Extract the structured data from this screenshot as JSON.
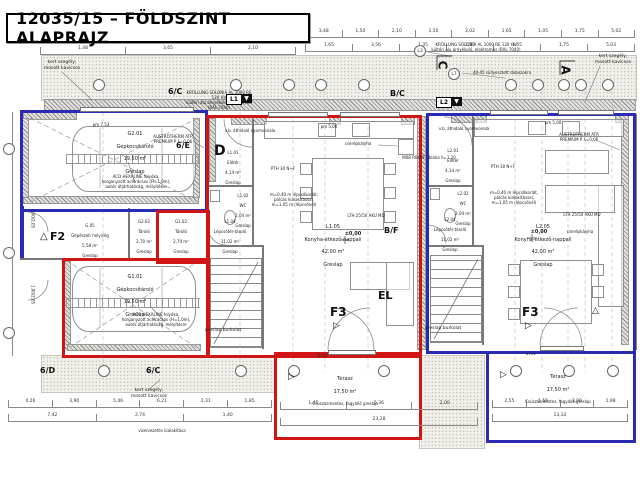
{
  "title": "12035/15 – FÖLDSZINT ALAPRAJZ",
  "colors": {
    "wall_blue": "#2a2ab5",
    "wall_red": "#d11414"
  },
  "rooms": {
    "g201": {
      "id": "G2.01",
      "name": "Gépkocsitároló",
      "area": "19,50 m²",
      "floor": "Greslap"
    },
    "g101": {
      "id": "G1.01",
      "name": "Gépkocsitároló",
      "area": "19,50 m²",
      "floor": "Greslap"
    },
    "g05": {
      "id": "G.05",
      "name": "Gépészeti helyiség",
      "area": "5,58 m²",
      "floor": "Greslap"
    },
    "g202": {
      "id": "G2.02",
      "name": "Tároló",
      "area": "2,70 m²",
      "floor": "Greslap"
    },
    "g102": {
      "id": "G1.02",
      "name": "Tároló",
      "area": "2,70 m²",
      "floor": "Greslap"
    },
    "l101": {
      "id": "L1.01",
      "name": "Előtér",
      "area": "4,14 m²",
      "floor": "Greslap"
    },
    "l102": {
      "id": "L1.02",
      "name": "WC",
      "area": "2,04 m²",
      "floor": "Greslap"
    },
    "l104": {
      "id": "L1.04",
      "name": "Lépcsőtér-tároló",
      "area": "11,02 m²",
      "floor": "Greslap"
    },
    "l105": {
      "id": "L1.05",
      "name": "Konyha-étkező-nappali",
      "area": "42,00 m²",
      "floor": "Greslap"
    },
    "l201": {
      "id": "L2.01",
      "name": "Előtér",
      "area": "4,14 m²",
      "floor": "Greslap"
    },
    "l202": {
      "id": "L2.02",
      "name": "WC",
      "area": "2,04 m²",
      "floor": "Greslap"
    },
    "l204": {
      "id": "L2.04",
      "name": "Lépcsőtér-tároló",
      "area": "11,02 m²",
      "floor": "Greslap"
    },
    "l205": {
      "id": "L2.05",
      "name": "Konyha-étkező-nappali",
      "area": "42,00 m²",
      "floor": "Greslap"
    },
    "terasz1": {
      "name": "Terasz",
      "area": "17,50 m²",
      "floor": "Csúszásmentes, fagyálló greslap"
    },
    "terasz2": {
      "name": "Terasz",
      "area": "17,50 m²",
      "floor": "Csúszásmentes, fagyálló greslap"
    }
  },
  "markers": {
    "m6c": "6/C",
    "m6e": "6/E",
    "m6d": "6/D",
    "mbc": "B/C",
    "mbf": "B/F",
    "d": "D",
    "a": "A",
    "c": "C",
    "el": "EL",
    "f2": "F2",
    "f3": "F3",
    "l1": "L1",
    "l2": "L2",
    "l3": "L3",
    "l7": "L7",
    "tri_right": "▷",
    "tri_up": "△",
    "tri_down": "▼"
  },
  "notes": {
    "kert": "kert szegély,\nmosott kavicsos",
    "krullung": "KRÜLLUNG SOLONIA AL 1000 RE 120 HV\nkültéri alu árnyékoló, elektromos (RAL 7040)",
    "dobozok": "40-45 süllyesztett dobozokra",
    "austrotherm": "AUSTROTHERM ATR\nPREMIUM P λ=0,06",
    "aco": "ACO HEXALINE folyóka,\nhorganyzott acélrácsos (H=1,0m),\nautós átjárhatóság, mélyítésre",
    "vb": "v.b. áthidaló nyomvonala",
    "pth": "PTH 30 N+F",
    "lth": "LTH 25/50 AKU MD",
    "cserep": "cserépkályha",
    "korlat": "m=0,40 m lépcsőkorlát,\npálcás kialakítással,\nm=1,05 m (lépcsőnél)",
    "mq": "M08 R04UF ablaka h=1,20",
    "greslap_burkolat": "greslap burkolat",
    "vizelvezetes": "vízelvezetés kialakítása",
    "pm5": "pm 5,00",
    "pm753": "pm 7,53",
    "level0": "±0,00",
    "m001": "-0,01",
    "doorcode": "1,00/2,05"
  },
  "dims": {
    "top_left": [
      "1,48",
      "3,65",
      "2,10"
    ],
    "top1": [
      "3,48",
      "1,50",
      "2,10",
      "1,50",
      "3,02",
      "1,65",
      "1,05",
      "1,75",
      "5,02"
    ],
    "top2": [
      "1,65",
      "3,56",
      "1,35",
      "2,25",
      "1,65",
      "1,75",
      "5,03"
    ],
    "bottom_left1": [
      "4,26",
      "3,90",
      "5,46",
      "6,21",
      "2,31",
      "1,85"
    ],
    "bottom_left2": [
      "7,42",
      "2,74",
      "1,40"
    ],
    "bottom_mid1": [
      "1,45",
      "5,36",
      "2,00"
    ],
    "bottom_mid2": [
      "23,28"
    ],
    "bottom_right1": [
      "2,55",
      "1,56",
      "3,90",
      "1,98"
    ],
    "bottom_right2": [
      "13,32"
    ]
  }
}
